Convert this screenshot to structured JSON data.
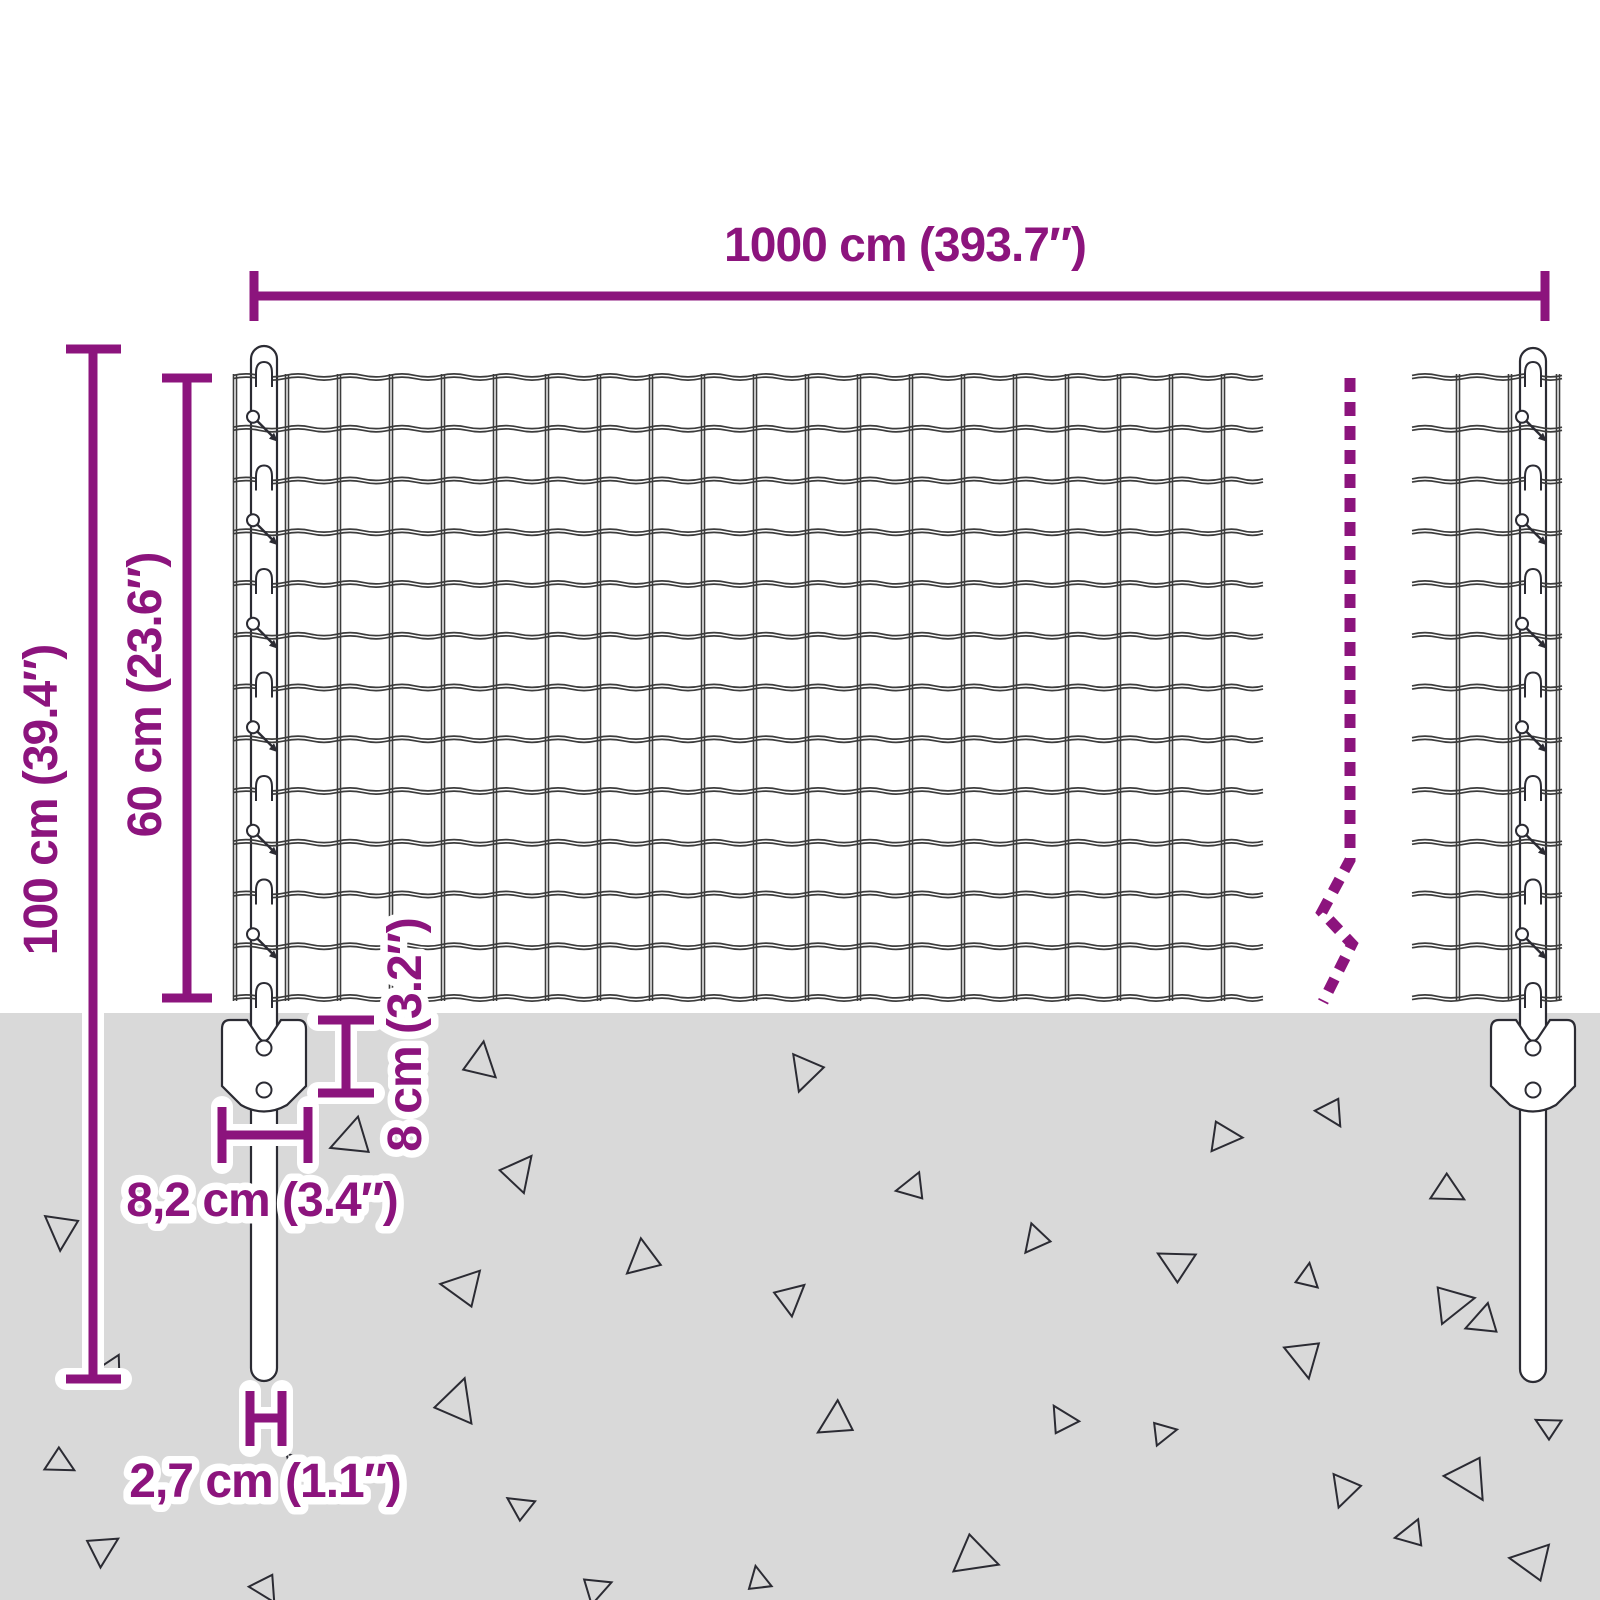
{
  "diagram": {
    "title": "fence-post-kit-dimension-diagram",
    "labels": {
      "total_width": "1000 cm (393.7″)",
      "post_height": "100 cm (39.4″)",
      "fence_height": "60 cm (23.6″)",
      "anchor_depth": "8 cm (3.2″)",
      "anchor_width": "8,2 cm (3.4″)",
      "post_diameter": "2,7 cm (1.1″)"
    },
    "colors": {
      "dimension": "#8C147D",
      "halo": "#FFFFFF",
      "ground": "#D9D9D9",
      "wire": "#3C3C3C",
      "outline": "#2B2B33"
    }
  }
}
